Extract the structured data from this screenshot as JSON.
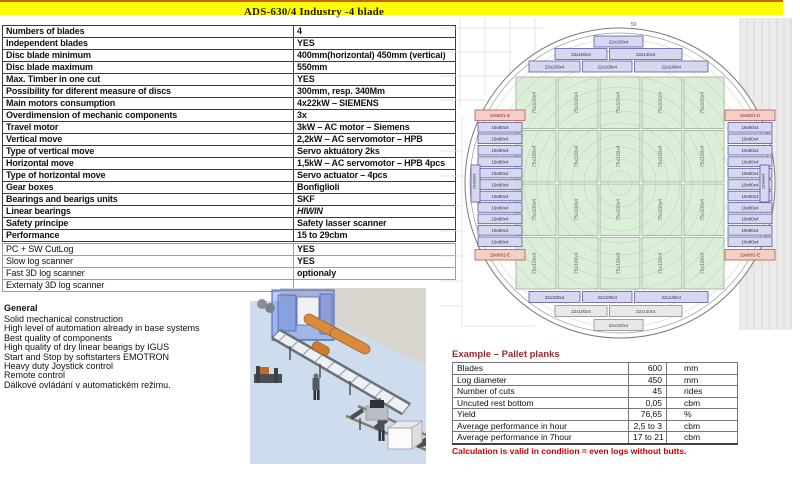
{
  "title": "ADS-630/4 Industry -4 blade",
  "spec_table": {
    "rows": [
      {
        "label": "Numbers of blades",
        "value": "4"
      },
      {
        "label": "Independent blades",
        "value": "YES"
      },
      {
        "label": "Disc blade minimum",
        "value": "400mm(horizontal) 450mm (vertical)"
      },
      {
        "label": "Disc blade maximum",
        "value": "550mm"
      },
      {
        "label": "Max. Timber in one cut",
        "value": "YES"
      },
      {
        "label": "Possibility for diferent measure of discs",
        "value": "300mm, resp. 340Mm"
      },
      {
        "label": "Main motors consumption",
        "value": "4x22kW – SIEMENS"
      },
      {
        "label": "Overdimension of mechanic components",
        "value": "3x"
      },
      {
        "label": "Travel motor",
        "value": "3kW – AC motor – Siemens"
      },
      {
        "label": "Vertical move",
        "value": "2,2kW – AC servomotor – HPB"
      },
      {
        "label": "Type of vertical move",
        "value": "Servo aktuátory 2ks"
      },
      {
        "label": "Horizontal move",
        "value": "1,5kW – AC servomotor – HPB 4pcs"
      },
      {
        "label": "Type of horizontal move",
        "value": "Servo actuator – 4pcs"
      },
      {
        "label": "Gear boxes",
        "value": "Bonfiglioli"
      },
      {
        "label": "Bearings and bearigs units",
        "value": "SKF"
      },
      {
        "label": "Linear bearings",
        "value": "HIWIN",
        "italic": true
      },
      {
        "label": "Safety principe",
        "value": "Safety lasser scanner"
      },
      {
        "label": "Performance",
        "value": "15 to 29cbm"
      }
    ]
  },
  "extras_table": {
    "rows": [
      {
        "label": "PC + SW CutLog",
        "value": "YES"
      },
      {
        "label": "Slow log scanner",
        "value": "YES"
      },
      {
        "label": "Fast 3D log scanner",
        "value": "optionaly"
      },
      {
        "label": "Externaly 3D log scanner",
        "value": ""
      }
    ]
  },
  "general": {
    "heading": "General",
    "lines": [
      "Solid mechanical construction",
      "High level of automation already in base systems",
      "Best quality of components",
      "High quality of dry linear bearigs by IGUS",
      "Start and Stop by softstarters  EMOTRON",
      "Heavy duty Joystick control",
      "Remote control",
      "Dálkové ovládání v automatickém režimu."
    ]
  },
  "example_table": {
    "title": "Example – Pallet planks",
    "rows": [
      {
        "label": "Blades",
        "value": "600",
        "unit": "mm"
      },
      {
        "label": "Log diameter",
        "value": "450",
        "unit": "mm"
      },
      {
        "label": "Number of cuts",
        "value": "45",
        "unit": "rides"
      },
      {
        "label": "Uncuted rest bottom",
        "value": "0,05",
        "unit": "cbm"
      },
      {
        "label": "Yield",
        "value": "76,65",
        "unit": "%"
      },
      {
        "label": "Average performance in hour",
        "value": "2,5 to 3",
        "unit": "cbm"
      },
      {
        "label": "Average performance in 7hour",
        "value": "17 to 21",
        "unit": "cbm"
      }
    ],
    "note": "Calculation is valid in condition = even logs without butts."
  },
  "diagram": {
    "dim_label": "50",
    "top_rows": [
      [
        "22x100x4"
      ],
      [
        "22x100x4",
        "22x140x4"
      ],
      [
        "22x100x4",
        "22x100x4",
        "22x140x4"
      ]
    ],
    "bottom_rows": [
      [
        "22x100x4",
        "22x100x4",
        "22x140x4"
      ],
      [
        "22x100x4",
        "22x140x4"
      ],
      [
        "22x100x4"
      ]
    ],
    "green_label": "75x100x4",
    "side_label": "19x80x4",
    "side_edge_label": "19x80/1-E",
    "side_count": 11
  },
  "colors": {
    "title_bg": "#ffff00",
    "note_red": "#cc0000",
    "example_title_red": "#9a2b2b",
    "green_fill": "#dcedd8",
    "lavender_fill": "#d6d8f0",
    "pink_fill": "#f4cfc8",
    "gray_fill": "#e8e8e8"
  }
}
